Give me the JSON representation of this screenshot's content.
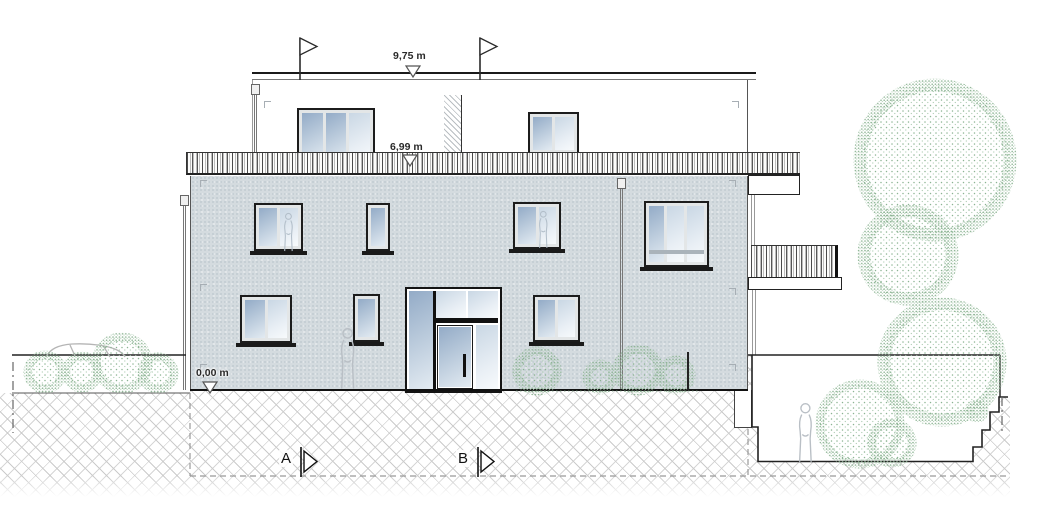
{
  "annotations": {
    "levels": [
      {
        "id": "roof-parapet",
        "label": "9,75 m"
      },
      {
        "id": "roof-terrace",
        "label": "6,99 m"
      },
      {
        "id": "ground",
        "label": "0,00 m"
      }
    ],
    "section_markers": [
      {
        "label": "A"
      },
      {
        "label": "B"
      }
    ]
  },
  "colors": {
    "facade": "#d4dbdf",
    "glass_dark": "#93abc7",
    "glass_light": "#e9eff5",
    "vegetation": "#8cb493",
    "hatch": "#cbcbcb",
    "silhouette": "#b9bfc5",
    "line": "#1b1b1b"
  }
}
